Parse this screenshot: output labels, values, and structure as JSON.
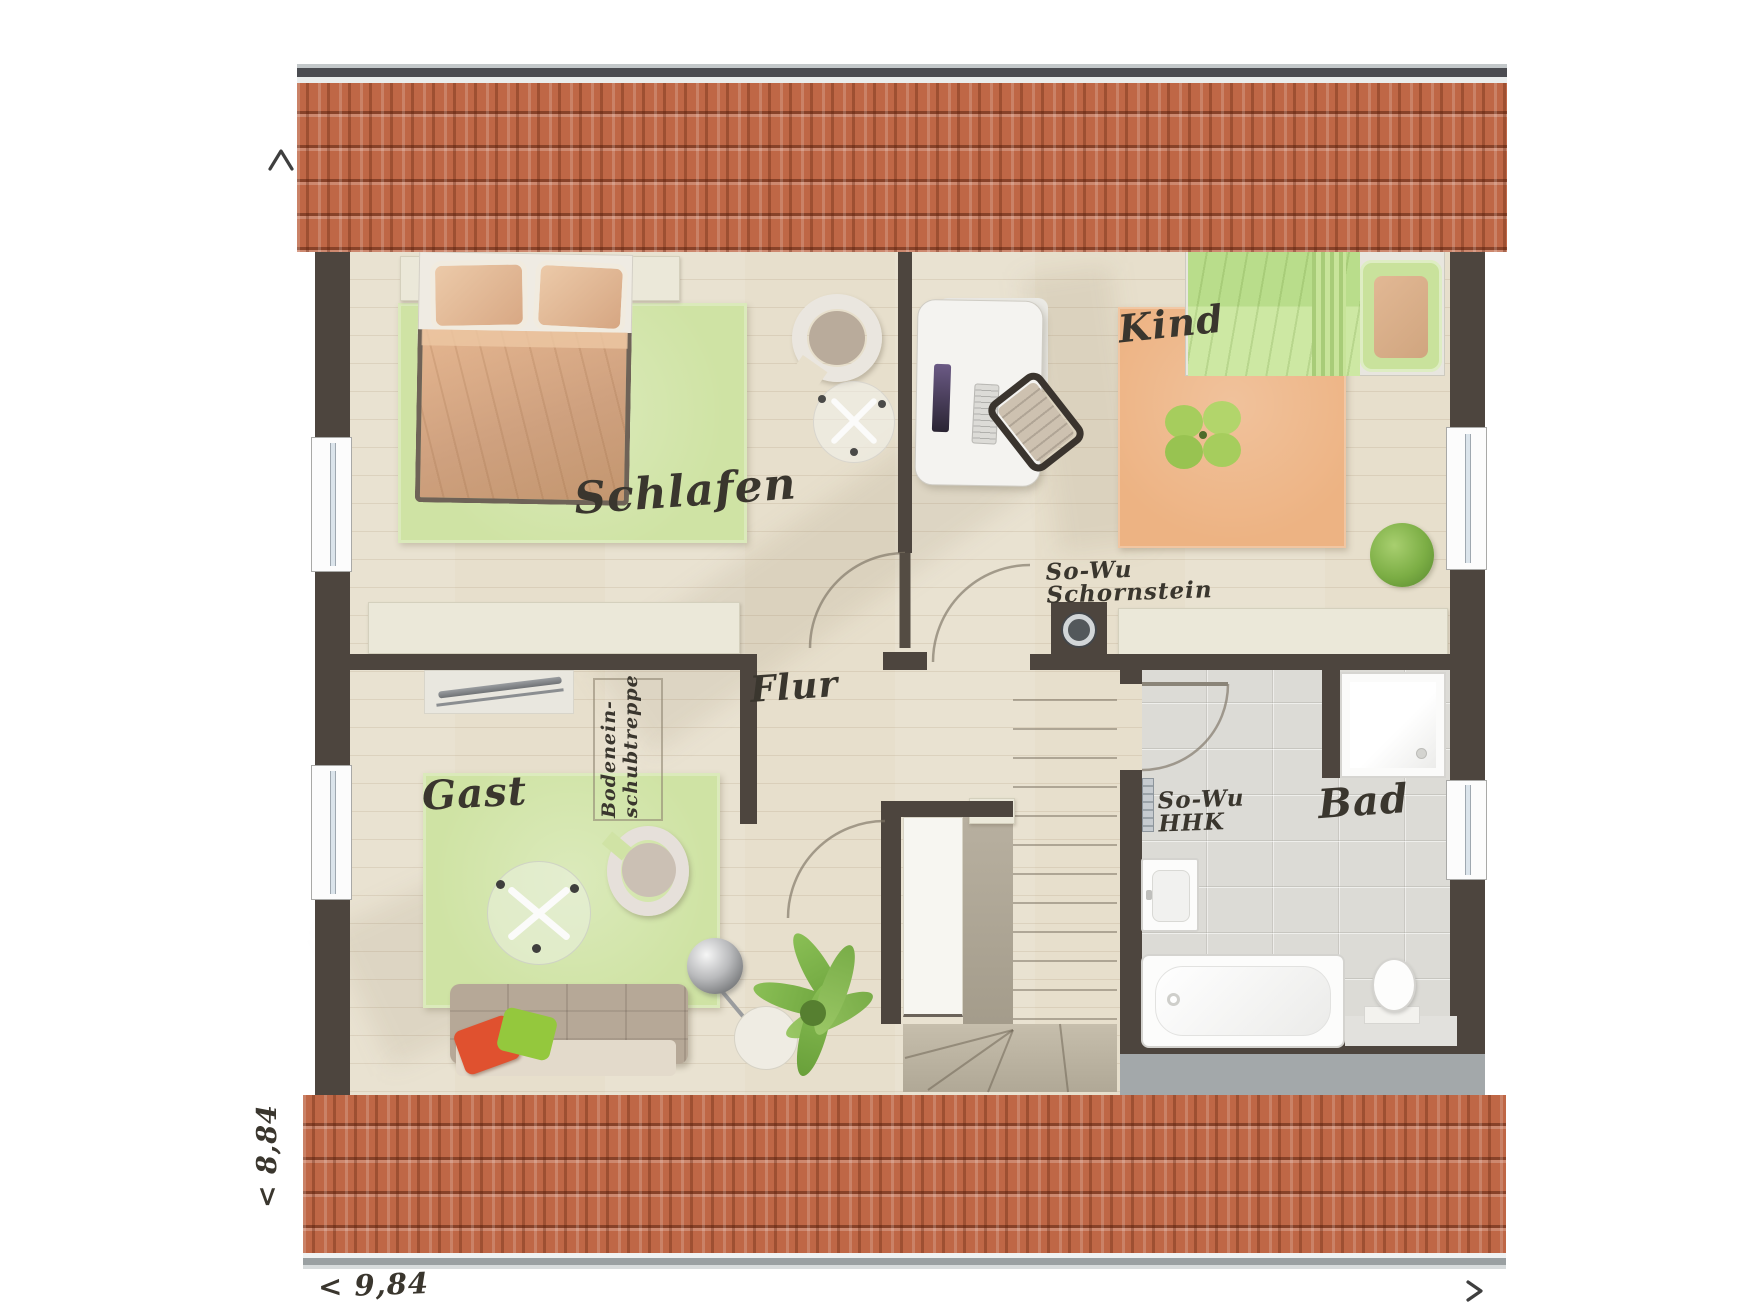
{
  "floorplan": {
    "rooms": {
      "schlafen": "Schlafen",
      "kind": "Kind",
      "gast": "Gast",
      "bad": "Bad",
      "flur": "Flur"
    },
    "annotations": {
      "chimney_line1": "So-Wu",
      "chimney_line2": "Schornstein",
      "radiator_line1": "So-Wu",
      "radiator_line2": "HHK",
      "loft_ladder_line1": "Bodenein-",
      "loft_ladder_line2": "schubtreppe"
    },
    "dimensions": {
      "bottom": "< 9,84",
      "left": "< 8,84",
      "arrow_up": "^",
      "arrow_right": ">"
    },
    "colors": {
      "wall": "#4d453e",
      "roof_tile": "#bf6746",
      "wood_floor": "#e7dfcc",
      "bath_tile": "#dcdbd6",
      "rug_green": "#cfe3a4",
      "rug_orange": "#edb383",
      "shelf_cream": "#ebe8d9"
    }
  }
}
